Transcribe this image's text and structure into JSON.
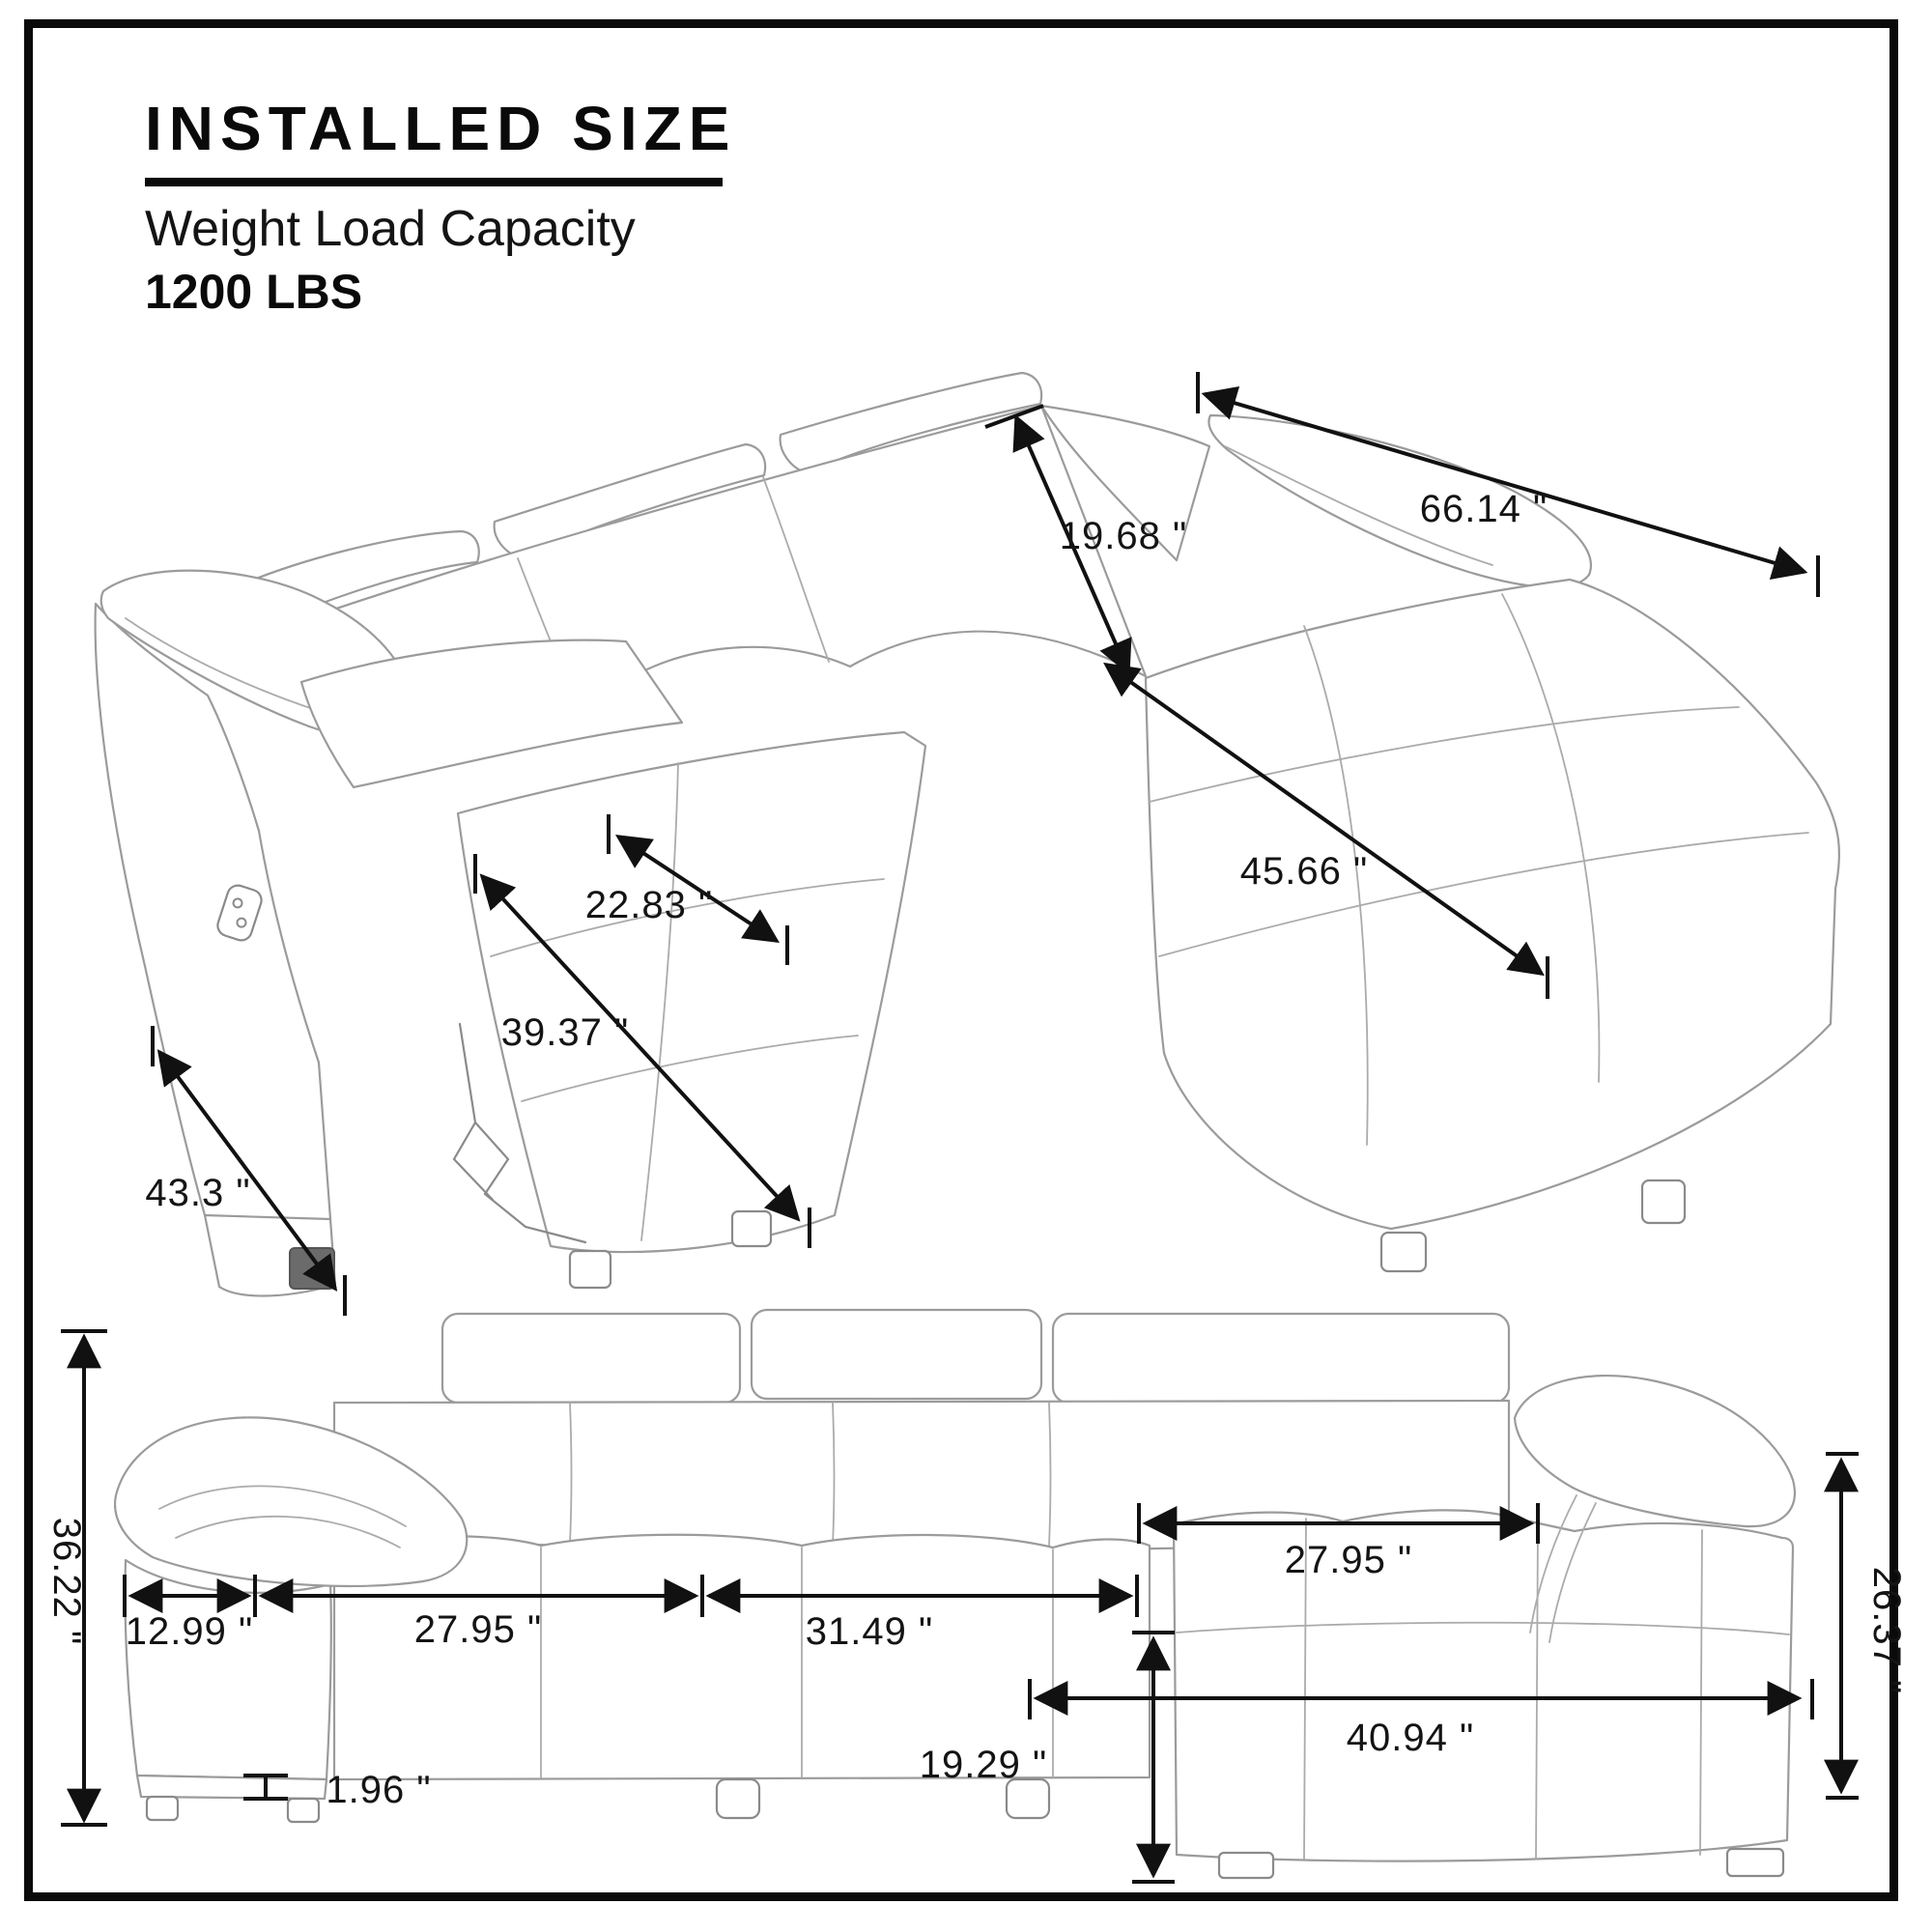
{
  "header": {
    "title": "INSTALLED  SIZE",
    "subtitle": "Weight Load Capacity",
    "capacity": "1200 LBS"
  },
  "top_view": {
    "description": "isometric line drawing of sectional recliner sofa with chaise",
    "dims": {
      "back_height": "19.68 \"",
      "total_width": "66.14 \"",
      "chaise_length": "45.66 \"",
      "seat_width": "22.83 \"",
      "recline_length": "39.37 \"",
      "base_depth": "43.3 \""
    }
  },
  "front_view": {
    "description": "front elevation line drawing of sectional sofa",
    "dims": {
      "overall_height": "36.22 \"",
      "arm_width": "12.99 \"",
      "left_seat_width": "27.95 \"",
      "right_seat_width": "31.49 \"",
      "chaise_seat_width": "27.95 \"",
      "chaise_arm_height": "26.37 \"",
      "chaise_length": "40.94 \"",
      "seat_height": "19.29 \"",
      "leg_height": "1.96 \""
    }
  }
}
